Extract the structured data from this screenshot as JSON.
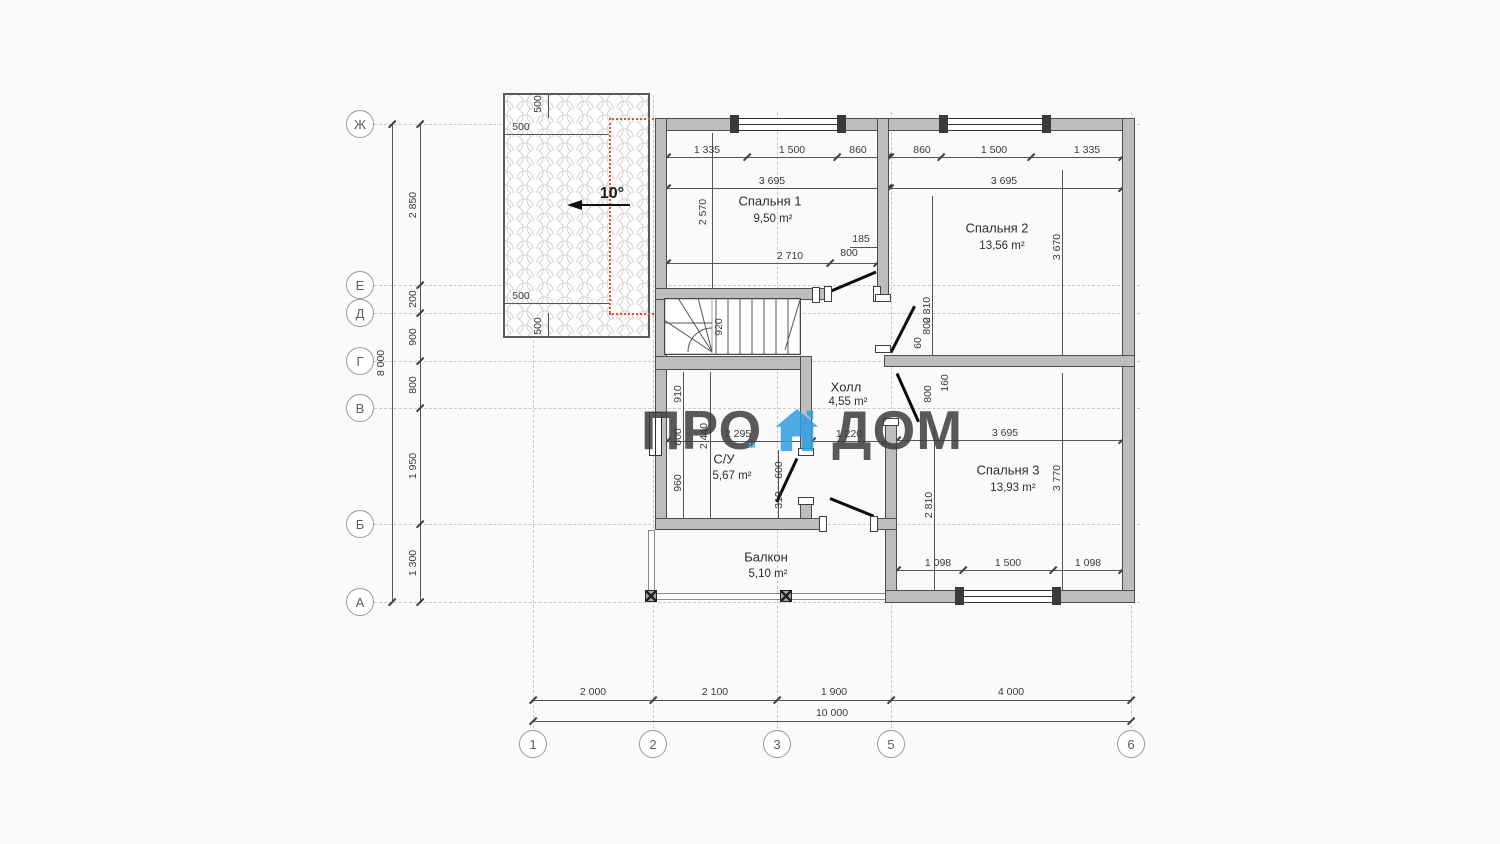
{
  "watermark": {
    "left": "ПРО",
    "right": "ДОМ",
    "sub": "м",
    "accent_color": "#2f9fe0"
  },
  "roof": {
    "angle": "10°",
    "off_top_v": "500",
    "off_top_h": "500",
    "off_bot_h": "500",
    "off_bot_v": "500"
  },
  "axes_rows": {
    "zh": "Ж",
    "e": "Е",
    "d": "Д",
    "g": "Г",
    "v": "В",
    "b": "Б",
    "a": "А"
  },
  "axes_cols": {
    "c1": "1",
    "c2": "2",
    "c3": "3",
    "c5": "5",
    "c6": "6"
  },
  "left_dims": {
    "total": "8 000",
    "d1": "2 850",
    "d2": "200",
    "d3": "900",
    "d4": "800",
    "d5": "1 950",
    "d6": "1 300"
  },
  "bottom_dims": {
    "total": "10 000",
    "d1": "2 000",
    "d2": "2 100",
    "d3": "1 900",
    "d4": "4 000"
  },
  "rooms": {
    "bedroom1": {
      "name": "Спальня 1",
      "area": "9,50 m²"
    },
    "bedroom2": {
      "name": "Спальня 2",
      "area": "13,56 m²"
    },
    "bedroom3": {
      "name": "Спальня 3",
      "area": "13,93 m²"
    },
    "hall": {
      "name": "Холл",
      "area": "4,55 m²"
    },
    "wc": {
      "name": "С/У",
      "area": "5,67 m²"
    },
    "balcony": {
      "name": "Балкон",
      "area": "5,10 m²"
    }
  },
  "dims": {
    "b1_t1": "1 335",
    "b1_t2": "1 500",
    "b1_t3": "860",
    "b1_w": "3 695",
    "b1_h": "2 570",
    "b1_b": "2 710",
    "b1_d185": "185",
    "b1_d800": "800",
    "b2_t1": "860",
    "b2_t2": "1 500",
    "b2_t3": "1 335",
    "b2_w": "3 695",
    "b2_h1": "2 810",
    "b2_h2": "3 670",
    "b2_d800": "800",
    "b2_d60": "60",
    "st920": "920",
    "hall1220": "1 220",
    "wc910": "910",
    "wc600a": "600",
    "wc960": "960",
    "wc2440": "2 440",
    "wc2295": "2 295",
    "wc600b": "600",
    "wc310": "310",
    "b3_w": "3 695",
    "b3_h1": "2 810",
    "b3_h2": "3 770",
    "b3_d800": "800",
    "b3_d160": "160",
    "b3_b1": "1 098",
    "b3_b2": "1 500",
    "b3_b3": "1 098"
  }
}
